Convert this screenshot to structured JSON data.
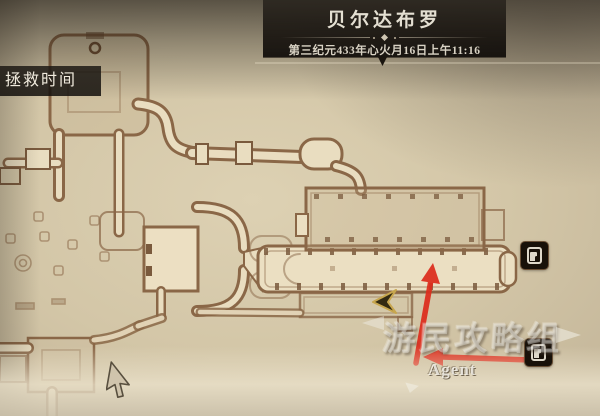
{
  "header": {
    "title": "贝尔达布罗",
    "datetime": "第三纪元433年心火月16日上午11:16"
  },
  "hud": {
    "save_time_label": "拯救时间"
  },
  "map": {
    "markers": [
      {
        "type": "exit-door",
        "icon": "door-icon"
      },
      {
        "type": "exit-door",
        "icon": "door-icon"
      }
    ],
    "player_marker_icon": "player-arrow-icon",
    "cursor_icon": "mouse-pointer-icon"
  },
  "annotations": {
    "arrows": [
      {
        "direction": "up"
      },
      {
        "direction": "left"
      }
    ],
    "arrow_color": "#dd2d1d"
  },
  "watermark": {
    "brand": "游民攻略组",
    "credit": "Agent"
  },
  "colors": {
    "parchment": "#d3c6a7",
    "wall_brown": "#8a6747",
    "corridor_fill": "#e9ddc0",
    "banner_bg": "#16120e",
    "arrow_red": "#dd2d1d",
    "marker_bg": "#181109",
    "player_gold": "#c7a64e"
  }
}
